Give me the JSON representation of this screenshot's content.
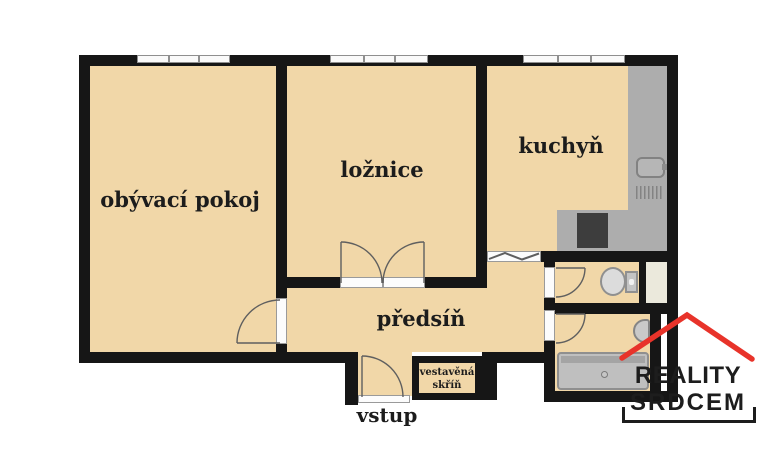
{
  "plan": {
    "rooms": {
      "living_room": "obývací pokoj",
      "bedroom": "ložnice",
      "kitchen": "kuchyň",
      "hallway": "předsíň",
      "entrance": "vstup",
      "built_in_wardrobe": "vestavěná skříň"
    },
    "fixtures": [
      "window",
      "door-swing",
      "folding-door",
      "kitchen-counter",
      "kitchen-sink",
      "dish-drainer",
      "stove",
      "toilet",
      "washbasin",
      "bathtub",
      "installation-shaft"
    ],
    "colors": {
      "floor": "#f1d7a8",
      "wall": "#161616",
      "kitchen_counter": "#adadad",
      "stove": "#3d3d3d",
      "shaft": "#ebe9dc"
    }
  },
  "logo": {
    "line1": "REALITY",
    "line2": "SRDCEM",
    "roof_color": "#e8332a",
    "text_color": "#1d1d1d"
  }
}
